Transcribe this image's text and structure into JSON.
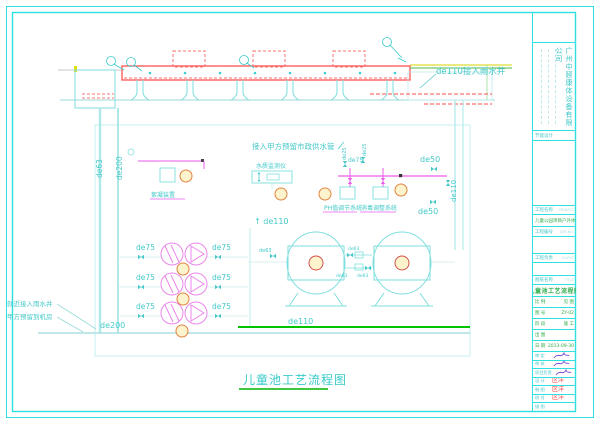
{
  "colors": {
    "frame_cyan": "#2ee0e0",
    "line_red": "#ff5353",
    "line_magenta": "#ea5bea",
    "line_green": "#00c300",
    "balloon_orange": "#e2833f",
    "sig_red": "#ff4343",
    "text_green": "#2fae4a"
  },
  "drawing": {
    "notes": {
      "gutter": "de110接入雨水井",
      "supply": "接入甲方预留市政供水管",
      "monitor": "水质监测仪",
      "floc": "絮凝装置",
      "ph": "PH值调节系统",
      "disinfect": "消毒调整系统",
      "near_well": "就近接入雨水井",
      "reserved": "甲方预留到机房",
      "caption": "儿童池工艺流程图"
    },
    "pipes": {
      "de63_v": "de63",
      "de200_v": "de200",
      "de200_b": "de200",
      "de110_v": "de110",
      "de110_up": "↑ de110",
      "de110_b": "de110",
      "de50_a": "de50",
      "de50_b": "de50",
      "de25_a": "de25",
      "de25_b": "de25",
      "de75_s": "de75",
      "de75_l1": "de75",
      "de75_l2": "de75",
      "de75_l3": "de75",
      "de75_r1": "de75",
      "de75_r2": "de75",
      "de75_r3": "de75",
      "de63_m1": "de63",
      "de63_m2": "de63",
      "de63_m3": "de63",
      "de63_t": "de63"
    }
  },
  "titleblock": {
    "company": "广州中颐康体设备有限公司",
    "energy": "节能设计",
    "rows": {
      "project_label": "工程名称",
      "project_en": "PROJECT",
      "project_name": "儿童公园项目户外体育设施",
      "jobno_label": "工程编号",
      "jobno_en": "JOB NO.",
      "client_label": "工程负责",
      "client_en": "CLIENT",
      "title_label": "图纸名称",
      "title_en": "TITLE",
      "drawing_title": "儿童池工艺流程图"
    },
    "info": [
      {
        "k": "比 例",
        "v": "见 图"
      },
      {
        "k": "图 号",
        "v": "ZY-02"
      },
      {
        "k": "阶 段",
        "v": "施 工"
      },
      {
        "k": "出 图",
        "v": ""
      },
      {
        "k": "日 期",
        "v": "2013-09-30"
      }
    ],
    "sigs": [
      {
        "k": "审 定",
        "en": "APPROVED",
        "v": ""
      },
      {
        "k": "审 核",
        "en": "CHECKED",
        "v": ""
      },
      {
        "k": "项目负责",
        "en": "PROJECT",
        "v": ""
      },
      {
        "k": "设 计",
        "en": "DESIGN",
        "v": "区洋"
      },
      {
        "k": "制 图",
        "en": "DRAWN",
        "v": "区洋"
      },
      {
        "k": "校 对",
        "en": "PROOF",
        "v": "区洋"
      },
      {
        "k": "描 图",
        "en": "TRACE",
        "v": ""
      }
    ]
  }
}
